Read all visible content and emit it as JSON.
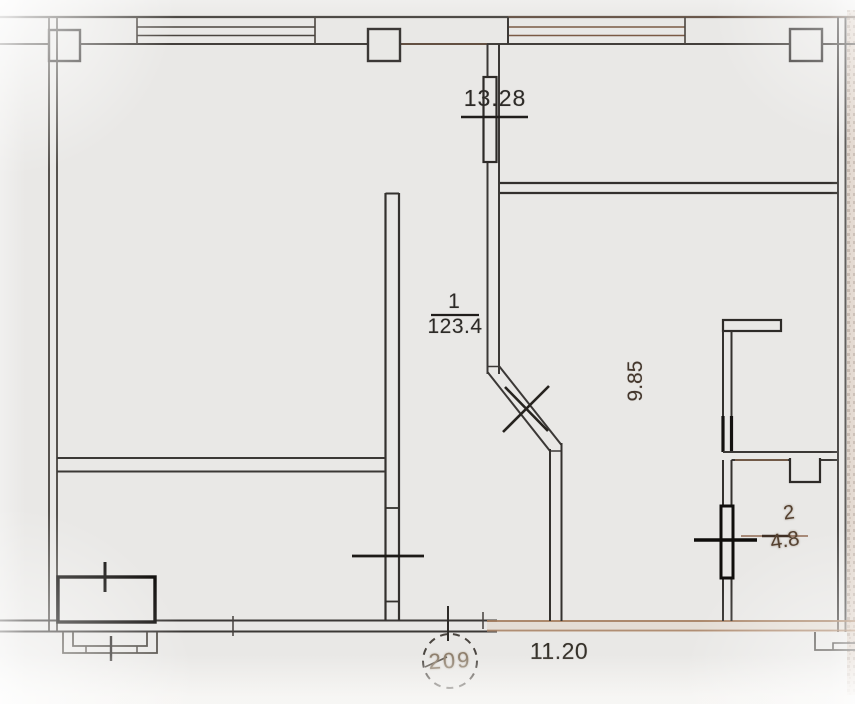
{
  "unit": {
    "number": "209"
  },
  "rooms": [
    {
      "id": "room-1",
      "number": "1",
      "area": "123.4"
    },
    {
      "id": "room-2",
      "number": "2",
      "area": "4.8"
    }
  ],
  "dimensions": {
    "top_window_width": "13.28",
    "right_room_depth": "9.85",
    "bottom_width": "11.20"
  },
  "colors": {
    "paper": "#e9e8e6",
    "ink": "#3b3836",
    "ink_heavy": "#141210",
    "sepia": "#96674a",
    "faded_label": "#8d7e6c"
  }
}
